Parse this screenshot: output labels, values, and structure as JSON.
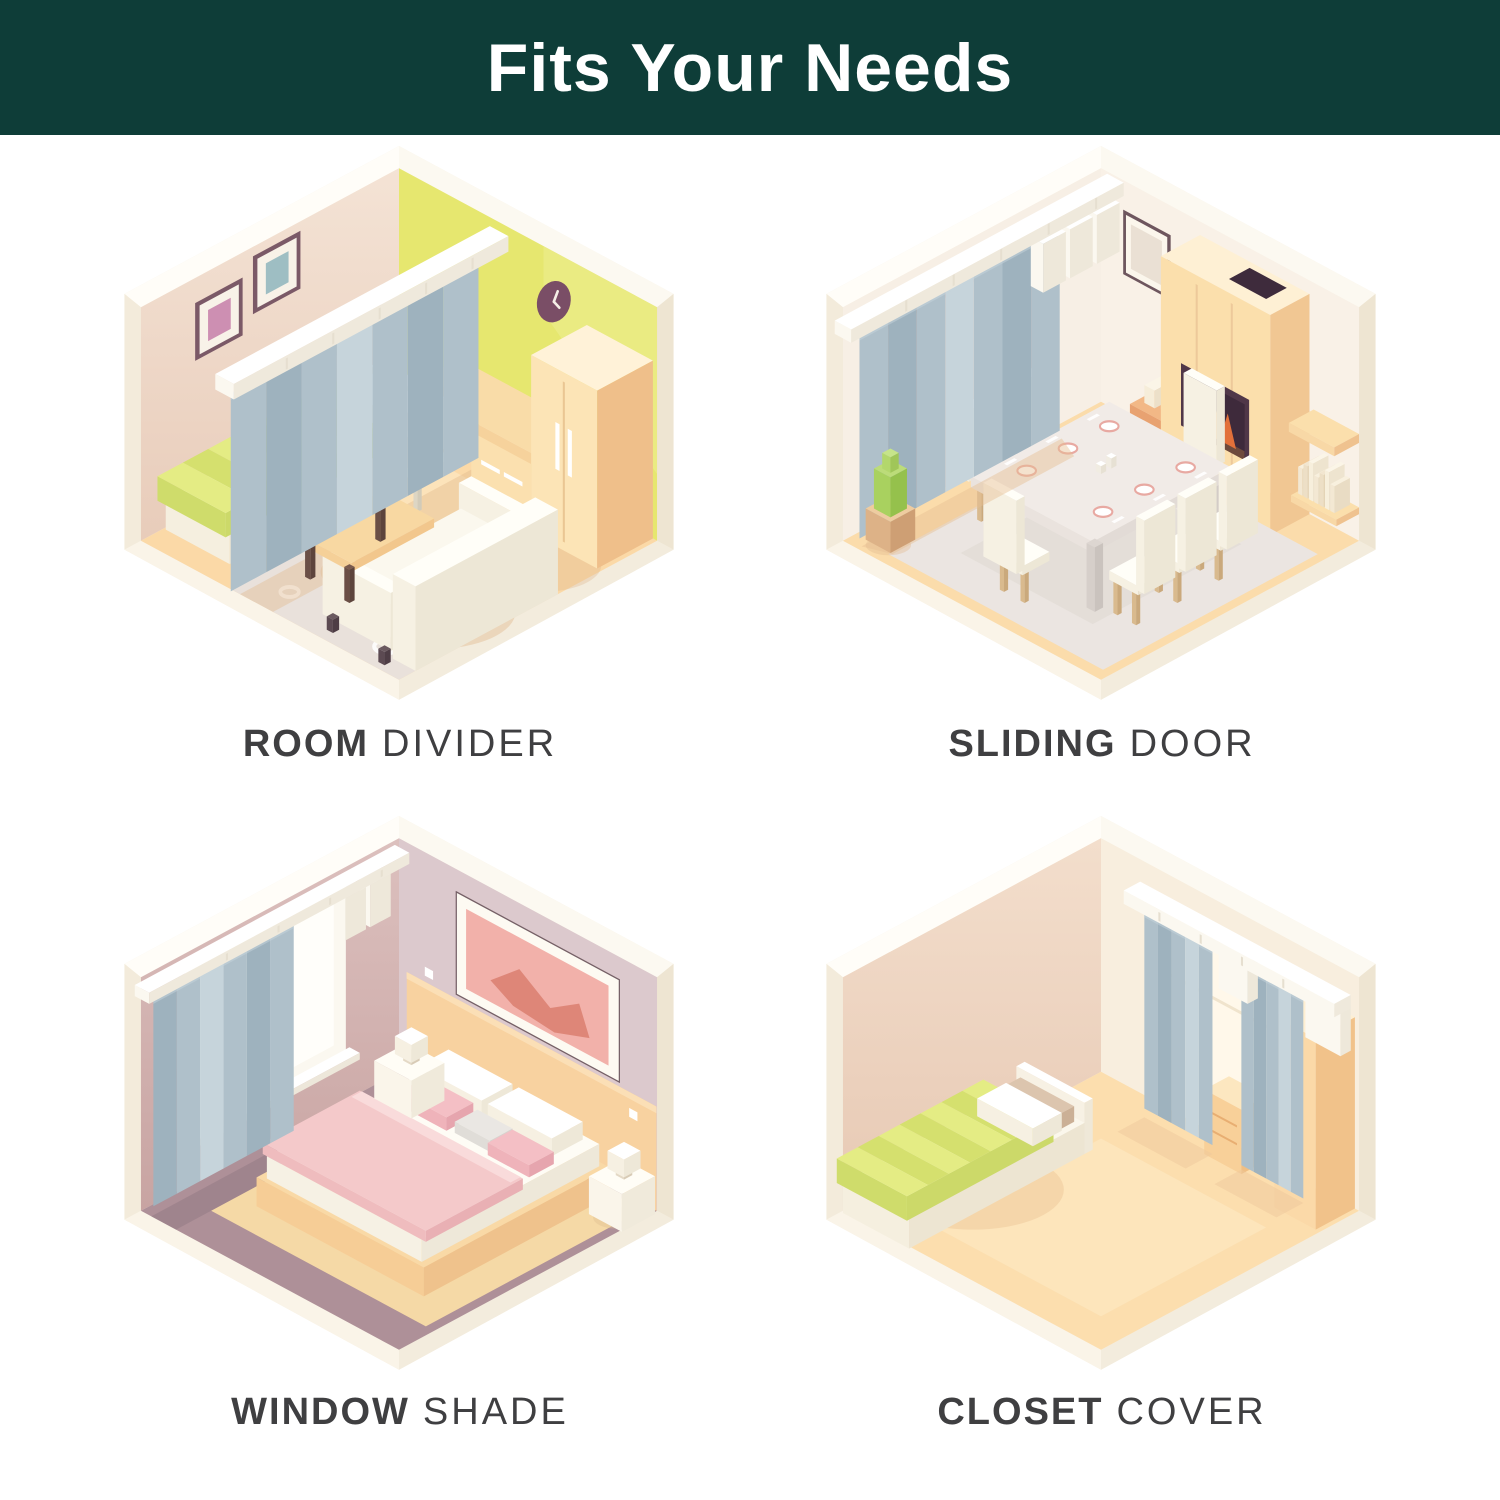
{
  "header": {
    "title": "Fits Your Needs"
  },
  "cards": [
    {
      "label_bold": "ROOM",
      "label_light": "DIVIDER"
    },
    {
      "label_bold": "SLIDING",
      "label_light": "DOOR"
    },
    {
      "label_bold": "WINDOW",
      "label_light": "SHADE"
    },
    {
      "label_bold": "CLOSET",
      "label_light": "COVER"
    }
  ],
  "palette": {
    "header_bg": "#0e3d38",
    "title_color": "#ffffff",
    "label_color": "#3f3f41",
    "curtain": "#afc0ca",
    "curtain_dark": "#9eb2be",
    "curtain_light": "#c6d4db",
    "rail_white": "#ffffff",
    "floor_peach": "#fbd9a7",
    "floor_mauve": "#ae9098",
    "wall_pink_beige": "#edd6c6",
    "wall_yellow_green": "#e6e76f",
    "wall_cream": "#f7efe5",
    "wall_mauve": "#d3b2b0",
    "wall_warm_beige": "#eacdb9",
    "furniture_peach": "#fbdfad",
    "bedding_green": "#dfe87d",
    "bedding_pink": "#f4c9ca"
  }
}
